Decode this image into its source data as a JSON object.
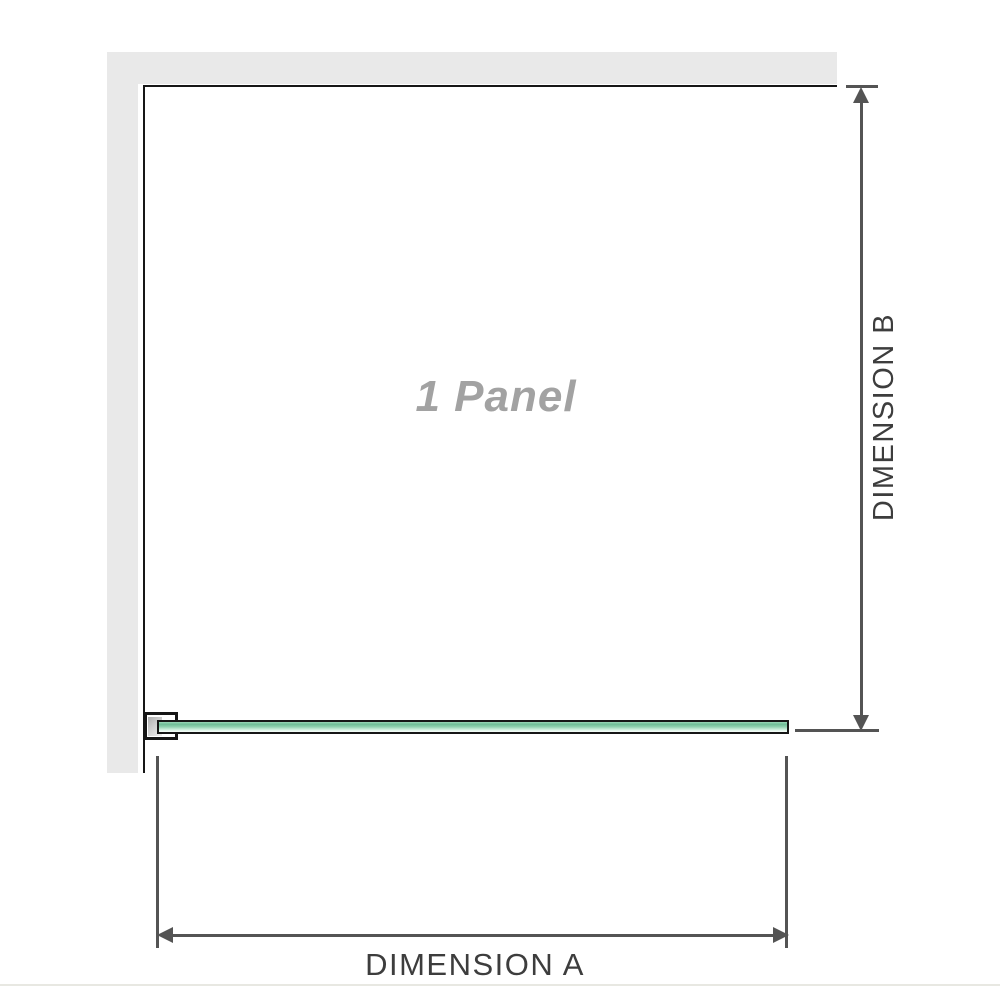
{
  "diagram": {
    "panel_label": "1 Panel",
    "dimension_a": {
      "label": "DIMENSION A",
      "orientation": "horizontal"
    },
    "dimension_b": {
      "label": "DIMENSION B",
      "orientation": "vertical"
    }
  },
  "icons": {
    "arrow_up": "▲",
    "arrow_down": "▼",
    "arrow_left": "◀",
    "arrow_right": "▶"
  },
  "colors": {
    "wall_fill": "#e9e9e9",
    "structure_line": "#161616",
    "dimension_line": "#545454",
    "dimension_text": "#3d3d3d",
    "panel_label_text": "#a2a2a2",
    "glass_green_top": "#6ebd96",
    "glass_green_light": "#e9f8f0",
    "page_rule": "#e8e8e2"
  }
}
